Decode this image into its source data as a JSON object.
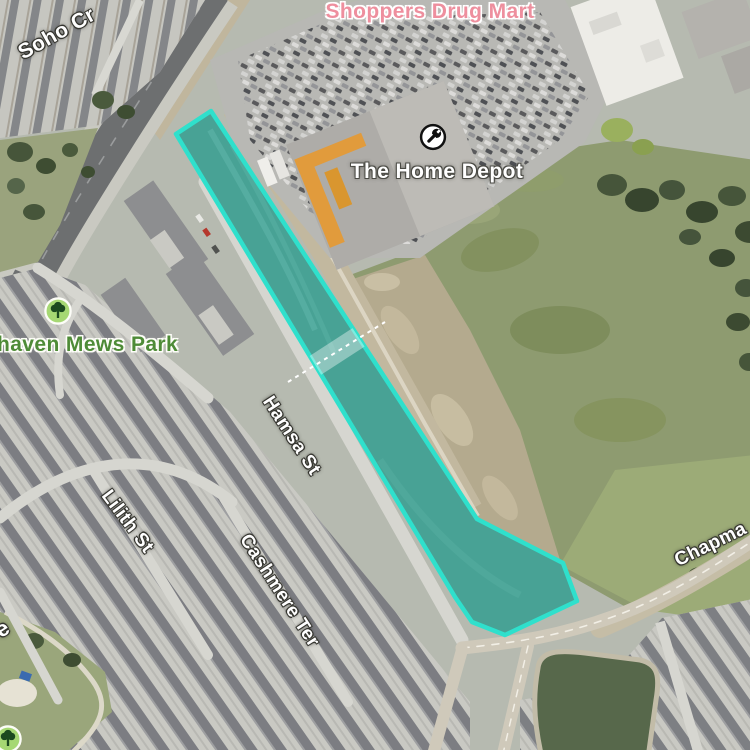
{
  "map": {
    "view_type": "satellite",
    "selection_overlay": {
      "stroke_color": "#2fe0cc",
      "fill_color": "#1fb3a3"
    },
    "poi": {
      "shoppers_drug_mart": {
        "label": "Shoppers Drug Mart",
        "color": "#ee8f9e",
        "type": "shopping"
      },
      "home_depot": {
        "label": "The Home Depot",
        "color": "#ffffff",
        "icon": "wrench",
        "type": "hardware-store"
      },
      "mews_park": {
        "label": "haven Mews Park",
        "color": "#4e8b37",
        "icon": "tree",
        "type": "park"
      }
    },
    "streets": {
      "soho_cr": "Soho Cr",
      "hamsa_st": "Hamsa St",
      "lilith_st": "Lilith St",
      "cashmere_ter": "Cashmere Ter",
      "chapman_partial": "Chapma",
      "left_edge_partial": "e"
    }
  }
}
